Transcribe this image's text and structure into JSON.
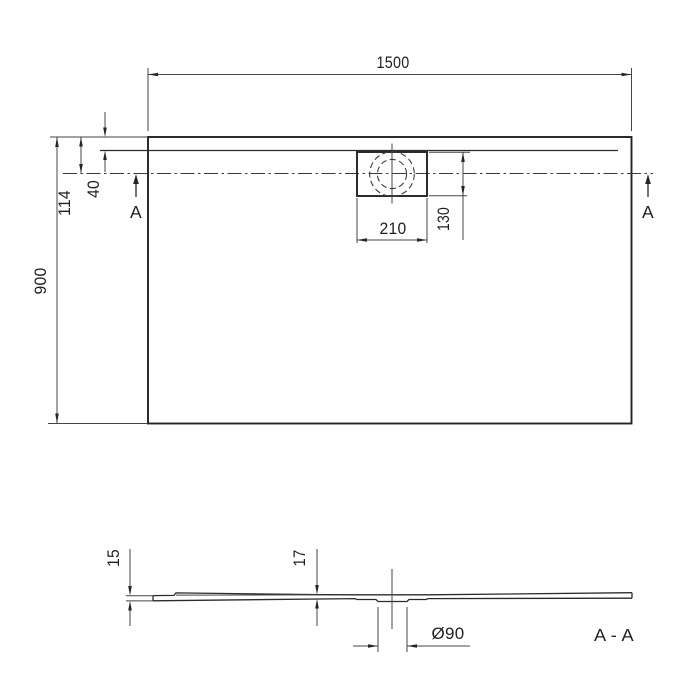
{
  "drawing": {
    "type": "shower-tray technical drawing, plan view and section view",
    "colors": {
      "line": "#222222",
      "thin_line": "#454545",
      "background": "#ffffff",
      "text": "#1f1f1f"
    },
    "plan": {
      "overall_width": "1500",
      "overall_depth": "900",
      "drain_center_from_edge": "114",
      "rim_to_inner_edge": "40",
      "drain_box_width": "210",
      "drain_box_depth": "130",
      "cut_marker_left": "A",
      "cut_marker_right": "A"
    },
    "section": {
      "edge_height": "15",
      "mid_height": "17",
      "drain_diameter": "Ø90",
      "section_label": "A - A"
    }
  }
}
